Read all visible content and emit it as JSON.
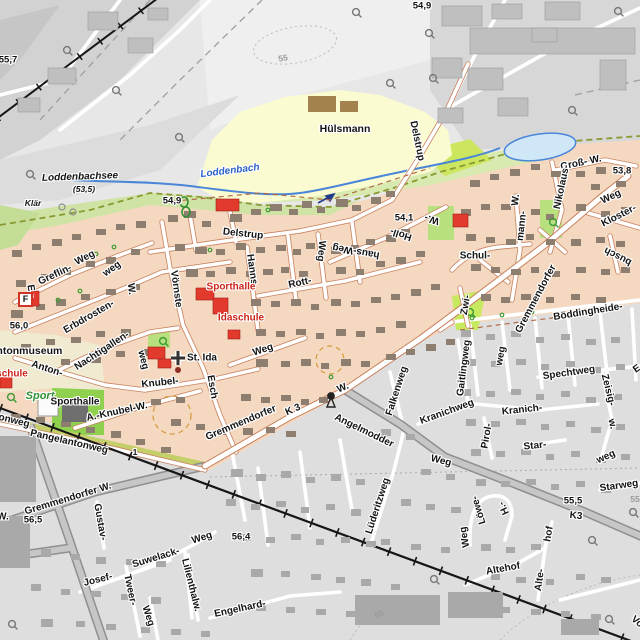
{
  "map": {
    "colors": {
      "residential_area": "#f4d8c0",
      "dimmed_area": "#dedede",
      "industrial_area": "#d3d3d3",
      "green_area": "#cfe3a5",
      "sports_green": "#8fd14f",
      "farm_field_yellow": "#fbfbd2",
      "water_line": "#4a86d8",
      "pond_fill": "#cfe7f7",
      "public_building_red": "#e23b2e",
      "building_residential": "#8e7e70",
      "building_dimmed": "#a9a9a9",
      "railway": "#161616",
      "street_casing": "#c8825f"
    },
    "labels": {
      "e55_7": "55,7",
      "e54_9a": "54,9",
      "e54_9b": "54,9",
      "e54_1": "54,1",
      "e53_8": "53,8",
      "e56_0": "56,0",
      "e56_5": "56,5",
      "e56_4": "56,4",
      "e55_5": "55,5",
      "c55a": "55",
      "c55b": "55",
      "c55c": "55",
      "loddenbachsee": "Loddenbachsee",
      "lake_elev": "(53,5)",
      "klaer": "Klär",
      "loddenbach": "Loddenbach",
      "huelsmann": "Hülsmann",
      "delstrup_v": "Delstrup",
      "delstrup_h": "Delstrup",
      "gross_w": "Groß- W.",
      "nikolaus": "Nikolaus-",
      "weg_ne": "Weg",
      "kloster": "Kloster-",
      "busch": "busch",
      "gremmendorfer": "Gremmendorfer",
      "schul": "Schul-",
      "mann": "mann-",
      "mann_w": "W.",
      "w_holl": "W.-",
      "holl": "Holl-",
      "haus_weg": "haus-Weg",
      "rott": "Rott-",
      "rott_weg": "Weg",
      "hanns": "Hanns-",
      "sporthalle_n": "Sporthalle",
      "idaschule": "Idaschule",
      "voernste": "Vörnste",
      "erbdrosten": "Erbdrosten-",
      "erbdrosten_weg": "weg",
      "e_str": "E.-",
      "greflin": "Greflin-",
      "greflin_weg": "Weg",
      "w_vert": "W.",
      "museum": "lantonmuseum",
      "schule": "schule",
      "anton": "Anton-",
      "nachtigallen": "Nachtigallen-",
      "nachtigallen_weg": "weg",
      "st_ida": "St. Ida",
      "weg_mid": "Weg",
      "knubel": "Knubel-",
      "esch": "Esch",
      "sport": "Sport",
      "sporthalle_s": "Sporthalle",
      "onweg": "onweg",
      "a_knubel_w": "A.-Knubel-W.",
      "pangelantonweg": "Pangelantonweg",
      "gremmendorfer_w": "Gremmendorfer W.",
      "w_edge": "W.",
      "gustav": "Gustav-",
      "suwelack": "Suwelack-",
      "suwelack_weg": "Weg",
      "josef": "Josef-",
      "tweer": "Tweer-",
      "tweer_weg": "Weg",
      "lilienthalw": "Lilienthalw.",
      "engelhard": "Engelhard-",
      "gremmendorfer_k3": "Gremmendorfer",
      "k3_west": "K 3",
      "w_shrine": "W.",
      "angelmodder": "Angelmodder",
      "angelmodder_weg": "Weg",
      "falkenweg": "Falkenweg",
      "luederitzweg": "Lüderitzweg",
      "kranichweg": "Kranichweg",
      "kranich": "Kranich-",
      "pirol": "Pirol-",
      "star": "Star-",
      "starweg": "Starweg",
      "spechtweg": "Spechtweg",
      "gaitlingweg": "Gaitlingweg",
      "gait_weg": "weg",
      "boeddingheide": "Böddingheide-",
      "zwi": "Zwi-",
      "zeisig": "Zeisig-",
      "zeisig_w": "w.",
      "weg_r": "weg",
      "e_partial": "E",
      "k3_east": "K3",
      "h_str": "H.-",
      "loewe": "Löwe-",
      "loewe_weg": "Weg",
      "altehof": "Altehof",
      "alte": "Alte-",
      "hof": "hof",
      "vo": "Vo",
      "km1": "1",
      "f_sign": "F"
    }
  }
}
